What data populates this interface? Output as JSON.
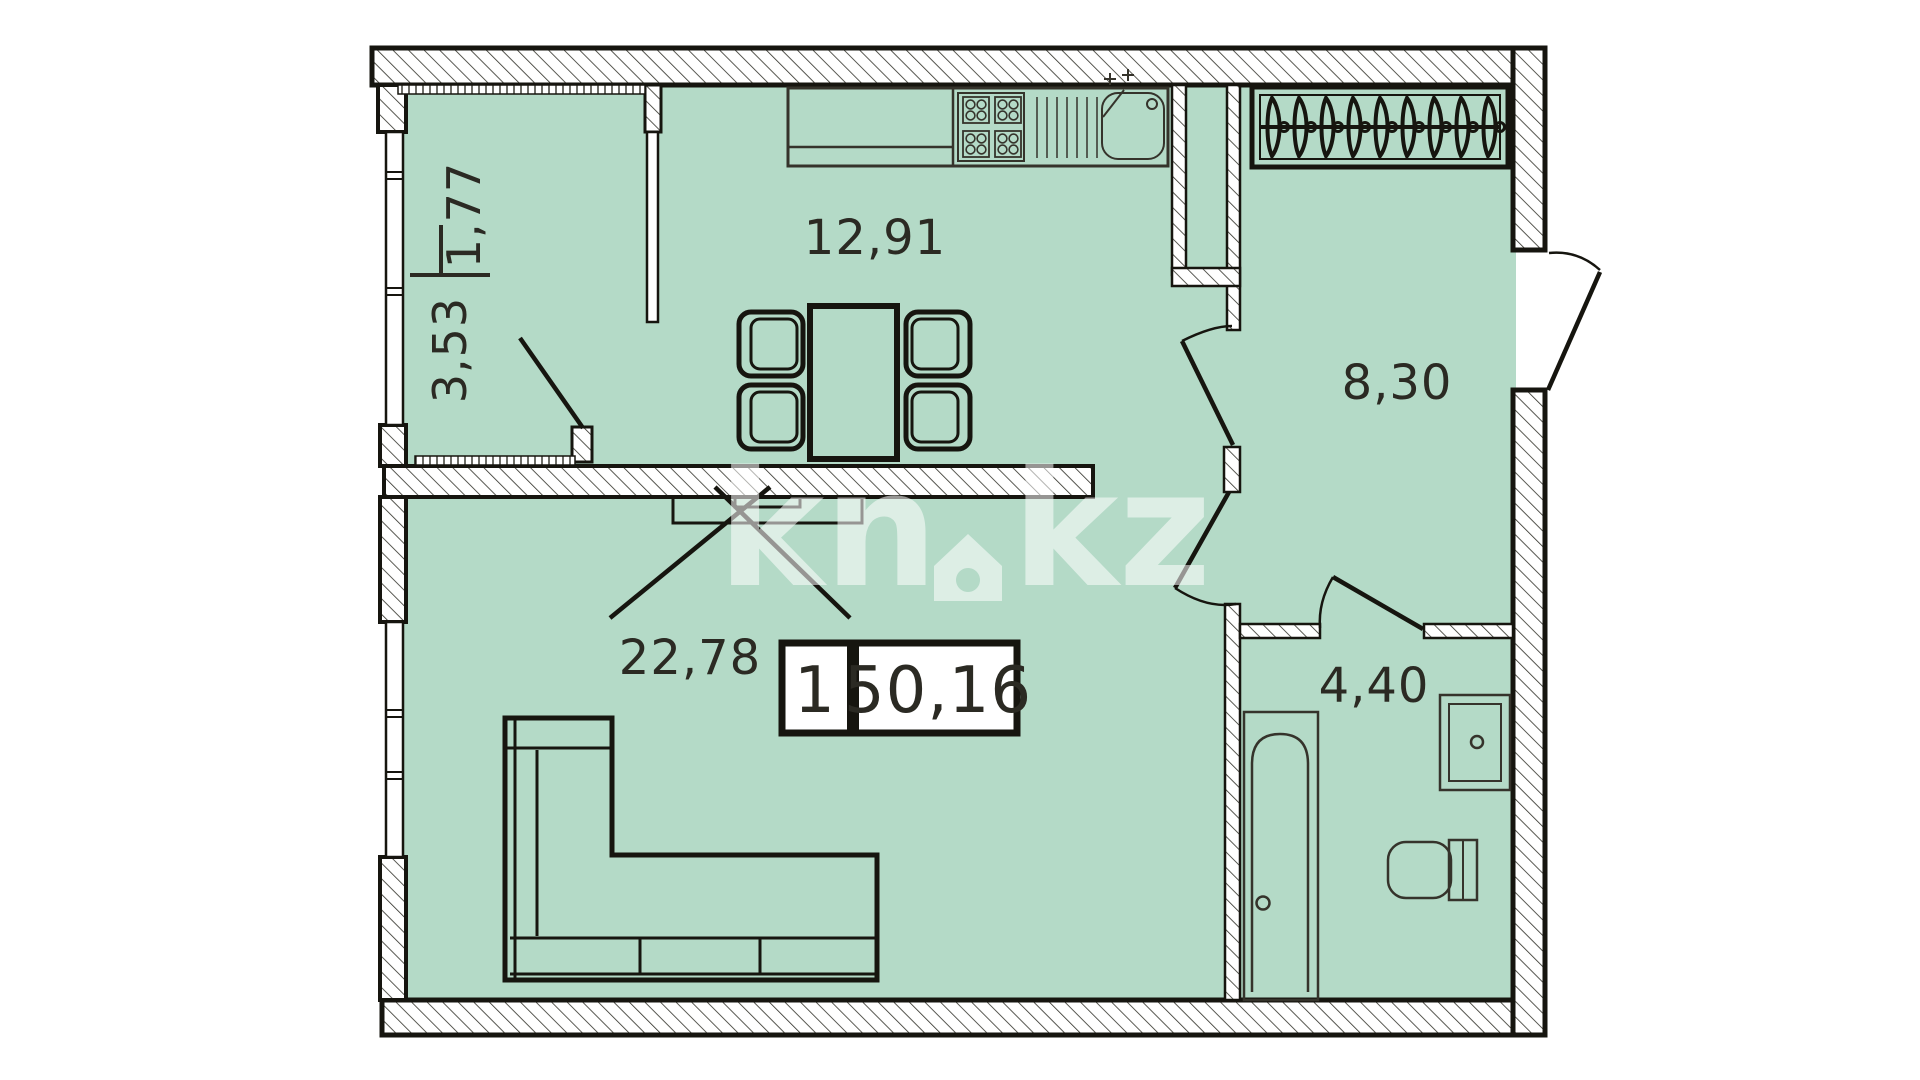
{
  "watermark": {
    "left": "kn",
    "right": "kz"
  },
  "badge": {
    "rooms_count": "1",
    "total_area": "50,16"
  },
  "rooms": {
    "kitchen": {
      "area": "12,91"
    },
    "hallway": {
      "area": "8,30"
    },
    "living_room": {
      "area": "22,78"
    },
    "bathroom": {
      "area": "4,40"
    },
    "balcony": {
      "area_reduced": "1,77",
      "area_full": "3,53"
    }
  },
  "colors": {
    "floor": "#b4dac7",
    "wall-line": "#16150f",
    "hatch-line": "#2f2f27",
    "furniture-line": "#35332b",
    "ink": "#2b2a23",
    "watermark": "#ffffff"
  }
}
